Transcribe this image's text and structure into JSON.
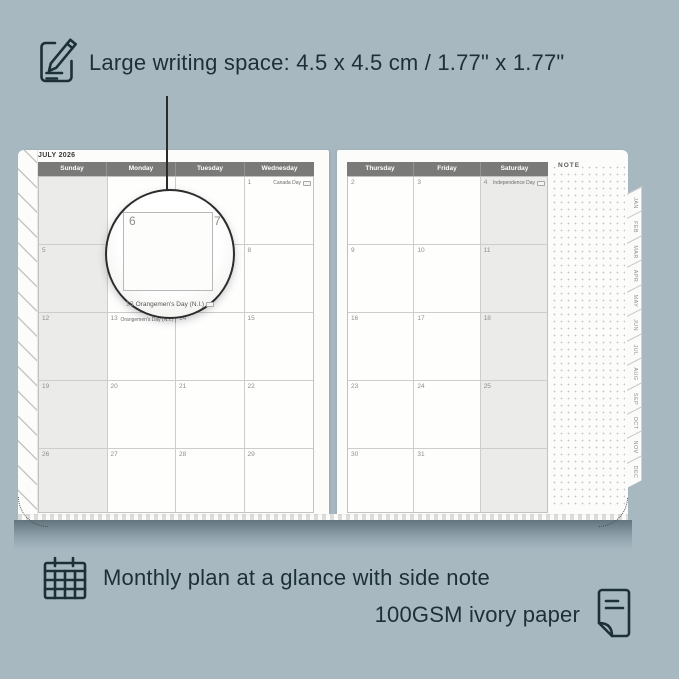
{
  "colors": {
    "background": "#a7b8c1",
    "ink": "#1d2f37",
    "page": "#fcfcfb",
    "weekend_shade": "#ebebe9",
    "header_bar": "#7a7a78",
    "grid_line": "#cdcdcb",
    "day_number": "#8e8e8c",
    "magnifier_border": "#2c2c2c"
  },
  "top_annotation": {
    "text": "Large writing space: 4.5 x 4.5 cm / 1.77\" x 1.77\""
  },
  "bottom_annotation": {
    "line1": "Monthly plan at a glance with side note",
    "line2": "100GSM ivory paper"
  },
  "planner": {
    "title": "JULY 2026",
    "note_label": "NOTE",
    "left_day_headers": [
      "Sunday",
      "Monday",
      "Tuesday",
      "Wednesday"
    ],
    "right_day_headers": [
      "Thursday",
      "Friday",
      "Saturday"
    ],
    "month_tabs": [
      "JAN",
      "FEB",
      "MAR",
      "APR",
      "MAY",
      "JUN",
      "JUL",
      "AUG",
      "SEP",
      "OCT",
      "NOV",
      "DEC"
    ],
    "left_rows": [
      [
        {
          "day": ""
        },
        {
          "day": ""
        },
        {
          "day": ""
        },
        {
          "day": "1",
          "event": "Canada Day"
        }
      ],
      [
        {
          "day": "5"
        },
        {
          "day": "6"
        },
        {
          "day": "7"
        },
        {
          "day": "8"
        }
      ],
      [
        {
          "day": "12"
        },
        {
          "day": "13",
          "event": "Orangemen's Day (N.I.)"
        },
        {
          "day": "14"
        },
        {
          "day": "15"
        }
      ],
      [
        {
          "day": "19"
        },
        {
          "day": "20"
        },
        {
          "day": "21"
        },
        {
          "day": "22"
        }
      ],
      [
        {
          "day": "26"
        },
        {
          "day": "27"
        },
        {
          "day": "28"
        },
        {
          "day": "29"
        }
      ]
    ],
    "right_rows": [
      [
        {
          "day": "2"
        },
        {
          "day": "3"
        },
        {
          "day": "4",
          "event": "Independence Day"
        }
      ],
      [
        {
          "day": "9"
        },
        {
          "day": "10"
        },
        {
          "day": "11"
        }
      ],
      [
        {
          "day": "16"
        },
        {
          "day": "17"
        },
        {
          "day": "18"
        }
      ],
      [
        {
          "day": "23"
        },
        {
          "day": "24"
        },
        {
          "day": "25"
        }
      ],
      [
        {
          "day": "30"
        },
        {
          "day": "31"
        },
        {
          "day": ""
        }
      ]
    ]
  },
  "magnifier": {
    "day_left": "6",
    "day_right": "7",
    "event_day": "13",
    "event": "Orangemen's Day (N.I.)"
  }
}
